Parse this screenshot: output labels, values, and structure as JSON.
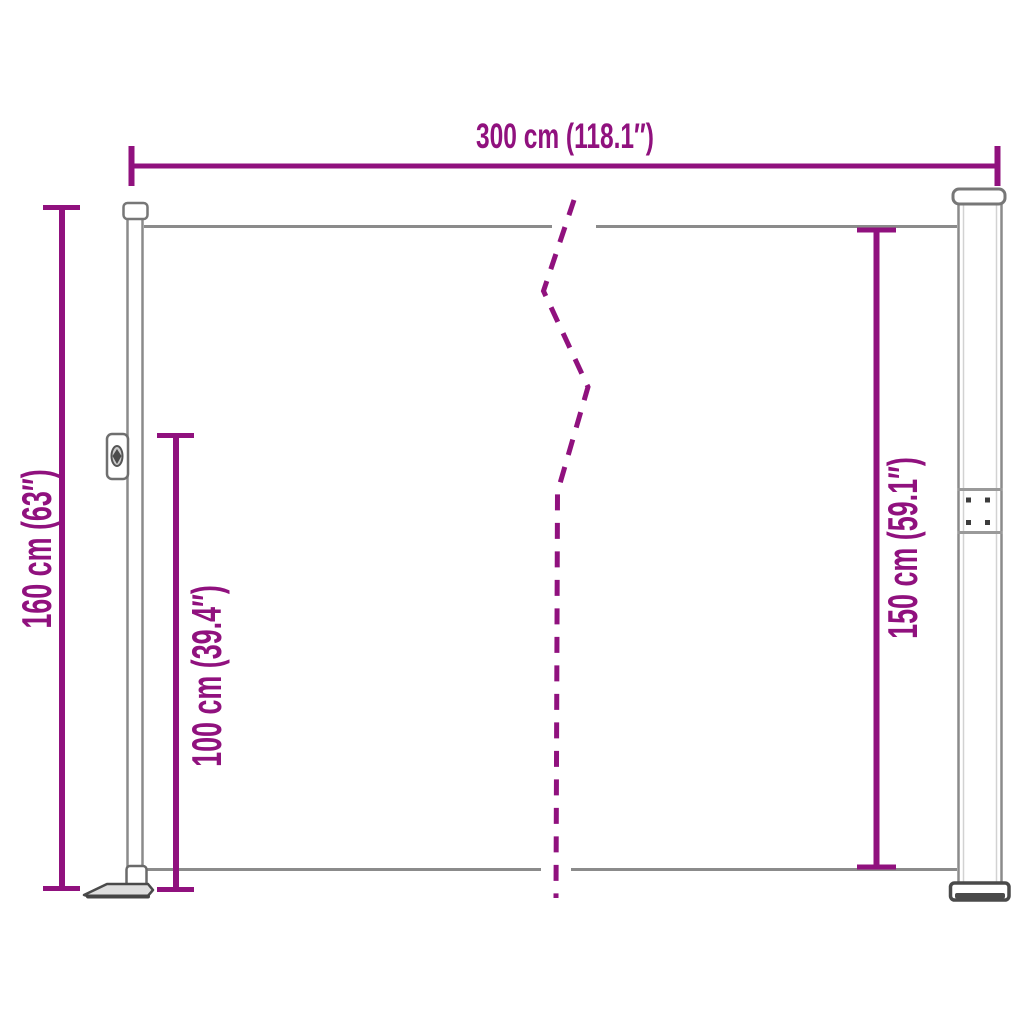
{
  "diagram": {
    "colors": {
      "dimension_accent": "#90117e",
      "structure_gray": "#8b8b8b",
      "dark_gray": "#4a4a4a",
      "background": "#ffffff"
    },
    "labels": {
      "width": "300 cm (118.1″)",
      "height_total": "160 cm (63″)",
      "height_inner": "100 cm (39.4″)",
      "height_right": "150 cm (59.1″)"
    }
  }
}
